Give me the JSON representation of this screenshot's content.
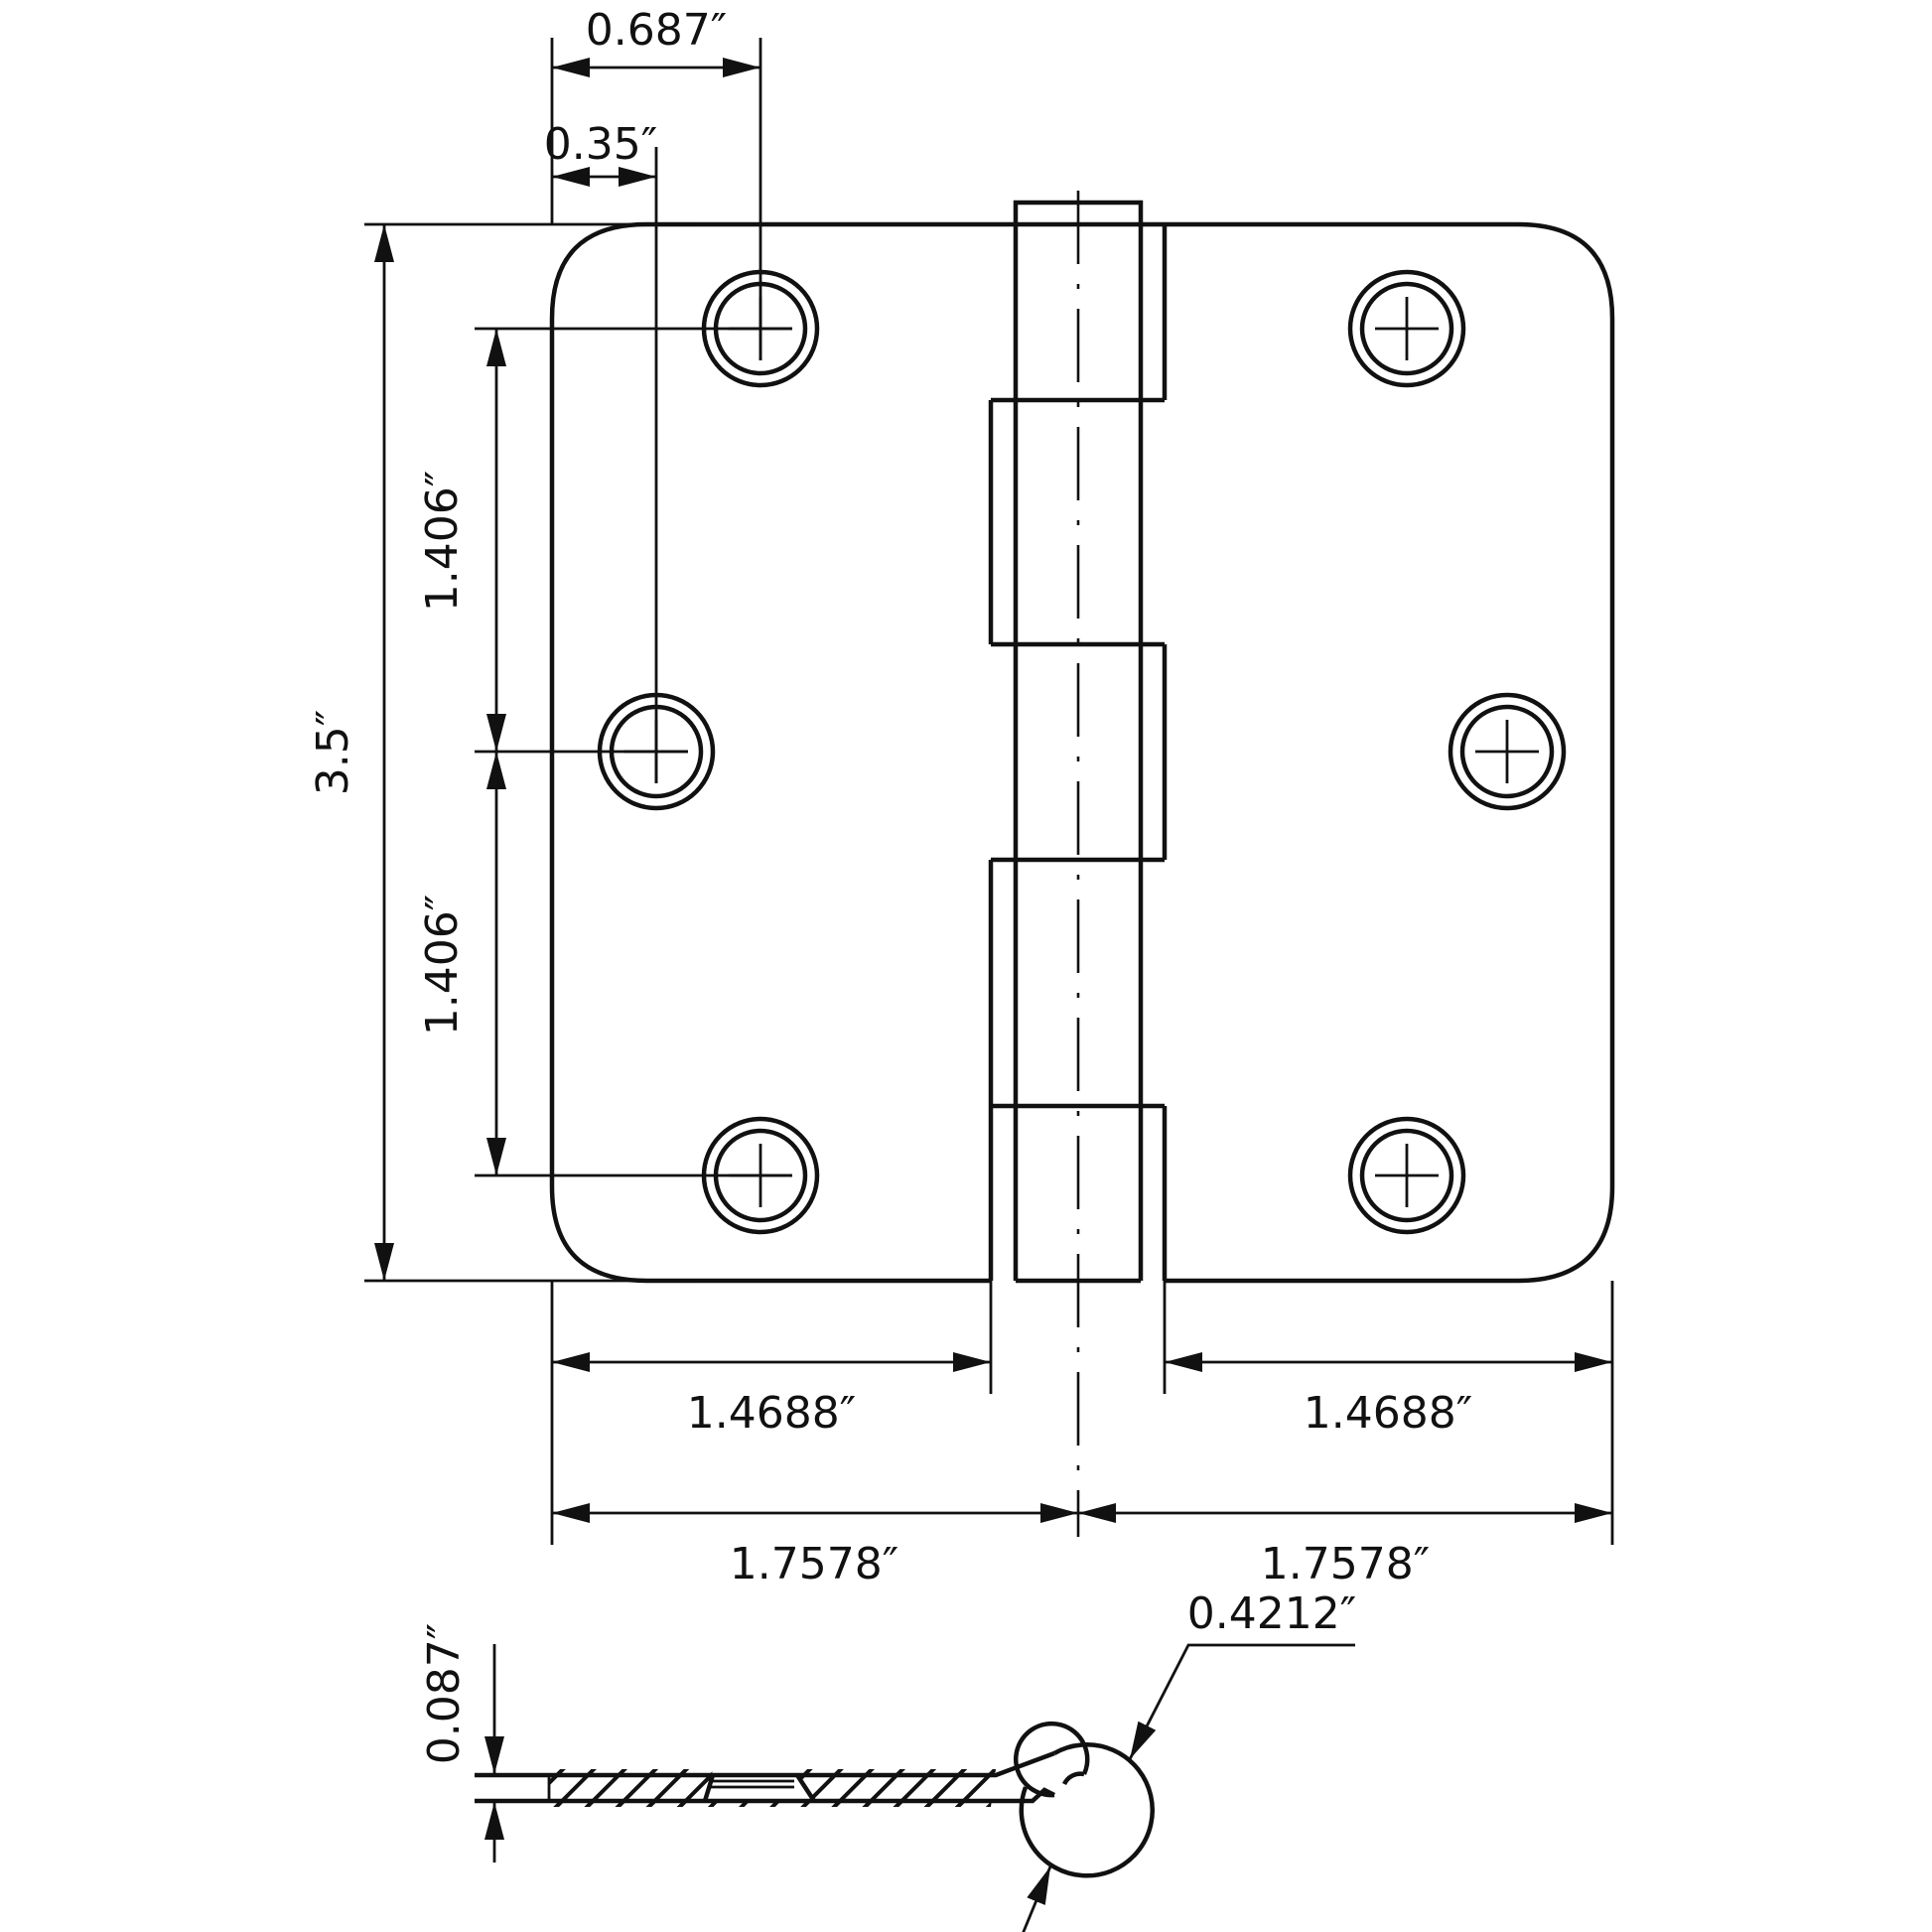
{
  "drawing": {
    "title": "Hinge dimensioned technical drawing",
    "colors": {
      "line": "#111111",
      "background": "#ffffff"
    }
  },
  "face": {
    "hole_offset_top": "0.687″",
    "hole_offset_middle": "0.35″",
    "leaf_height": "3.5″",
    "hole_spacing_upper": "1.406″",
    "hole_spacing_lower": "1.406″",
    "leaf_flat_width_left": "1.4688″",
    "leaf_flat_width_right": "1.4688″",
    "leaf_total_width_left": "1.7578″",
    "leaf_total_width_right": "1.7578″"
  },
  "section": {
    "leaf_thickness": "0.087″",
    "knuckle_diameter": "0.4212″"
  }
}
